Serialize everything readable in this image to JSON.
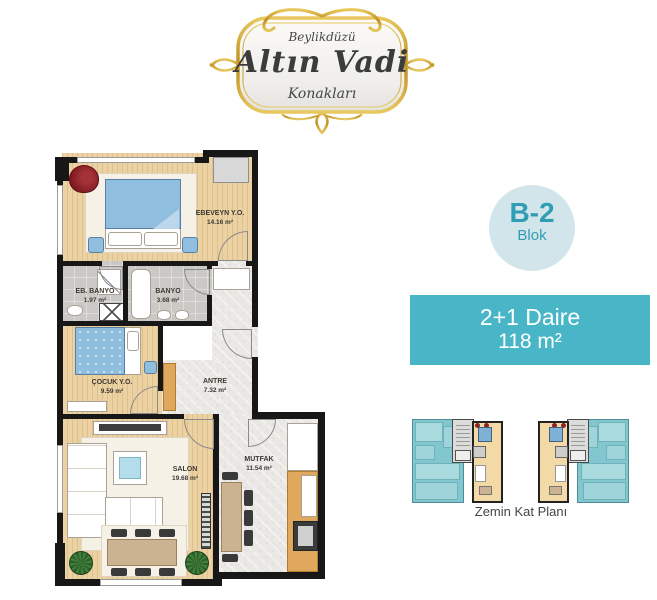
{
  "logo": {
    "location": "Beylikdüzü",
    "name": "Altın Vadi",
    "subtitle": "Konakları"
  },
  "badge": {
    "block": "B-2",
    "label": "Blok"
  },
  "unit": {
    "type": "2+1 Daire",
    "area": "118 m²"
  },
  "floor_caption": "Zemin Kat Planı",
  "rooms": [
    {
      "id": "ebeveyn",
      "name": "EBEVEYN Y.O.",
      "area": "14.16 m²"
    },
    {
      "id": "eb_banyo",
      "name": "EB. BANYO",
      "area": "1.97 m²"
    },
    {
      "id": "banyo",
      "name": "BANYO",
      "area": "3.68 m²"
    },
    {
      "id": "cocuk",
      "name": "ÇOCUK Y.O.",
      "area": "9.59 m²"
    },
    {
      "id": "antre",
      "name": "ANTRE",
      "area": "7.32 m²"
    },
    {
      "id": "salon",
      "name": "SALON",
      "area": "19.68 m²"
    },
    {
      "id": "mutfak",
      "name": "MUTFAK",
      "area": "11.54 m²"
    }
  ],
  "colors": {
    "accent_teal": "#49b6c8",
    "badge_bg": "#d2e5ea",
    "badge_text": "#2f9eb4",
    "wall": "#171717",
    "wood_floor": "#ecd2a2",
    "gold": "#c79a2a"
  }
}
